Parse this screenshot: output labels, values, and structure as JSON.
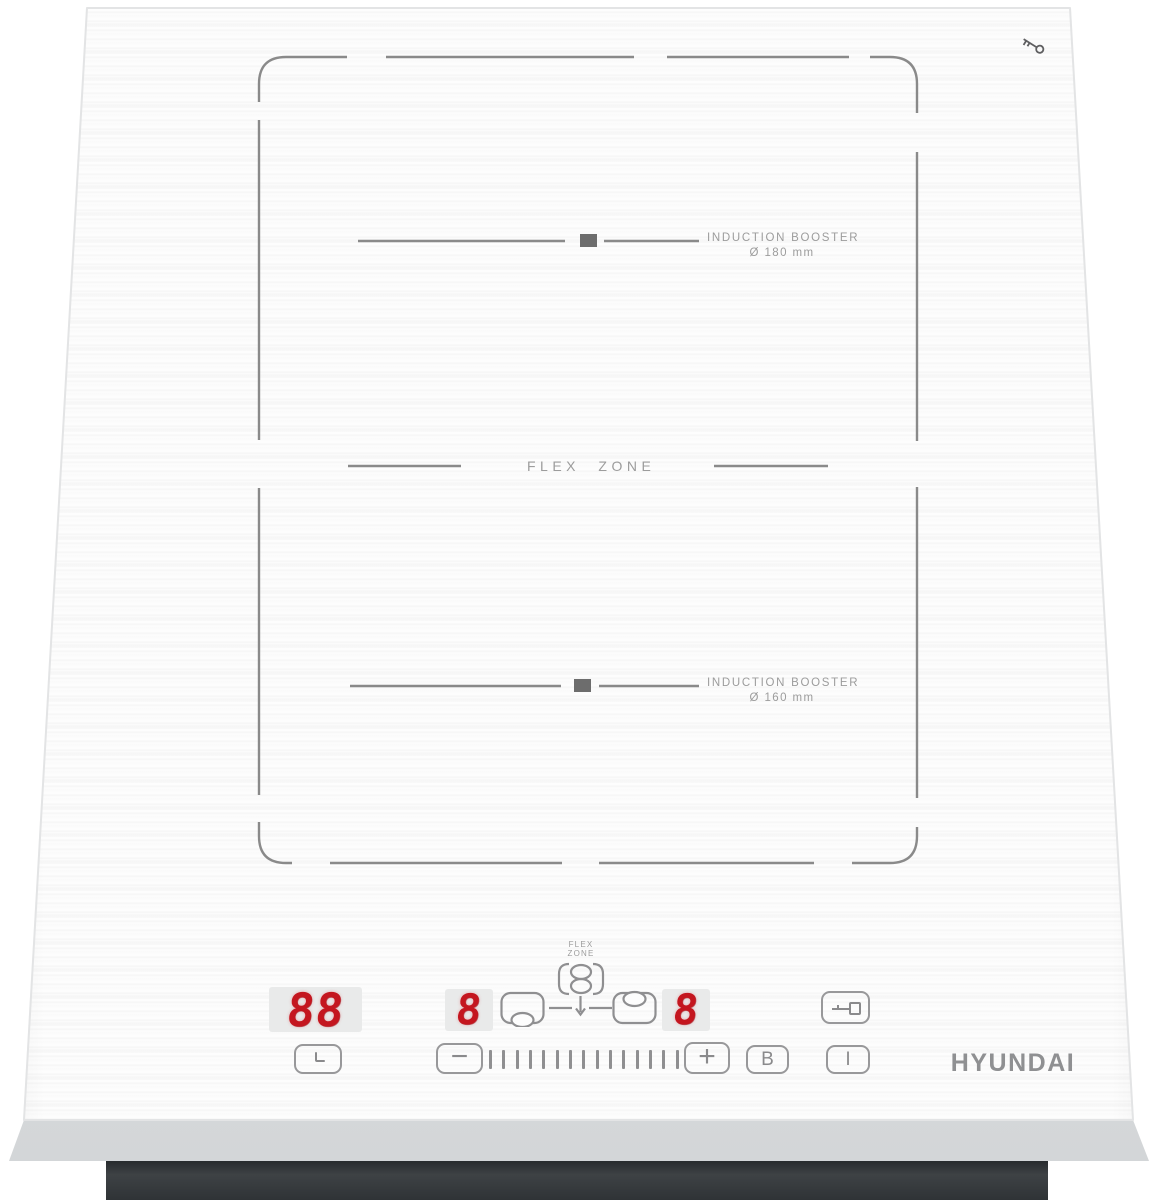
{
  "glass": {
    "corner_lock_icon": "key-icon"
  },
  "zones": {
    "booster_top": {
      "title": "INDUCTION BOOSTER",
      "diameter": "Ø 180 mm"
    },
    "flex": {
      "label": "FLEX ZONE"
    },
    "booster_bottom": {
      "title": "INDUCTION BOOSTER",
      "diameter": "Ø 160 mm"
    }
  },
  "panel": {
    "displays": {
      "timer": "88",
      "zone_left": "8",
      "zone_right": "8"
    },
    "flex_key": {
      "line1": "FLEX",
      "line2": "ZONE"
    },
    "buttons": {
      "minus": "−",
      "plus": "+",
      "booster": "B",
      "power": "I"
    },
    "slider_tick_count": 15
  },
  "brand": "HYUNDAI",
  "colors": {
    "led_red": "#c4161f",
    "line_gray": "#8a8a8a",
    "label_gray": "#9c9c9c",
    "base_dark": "#35383a"
  }
}
